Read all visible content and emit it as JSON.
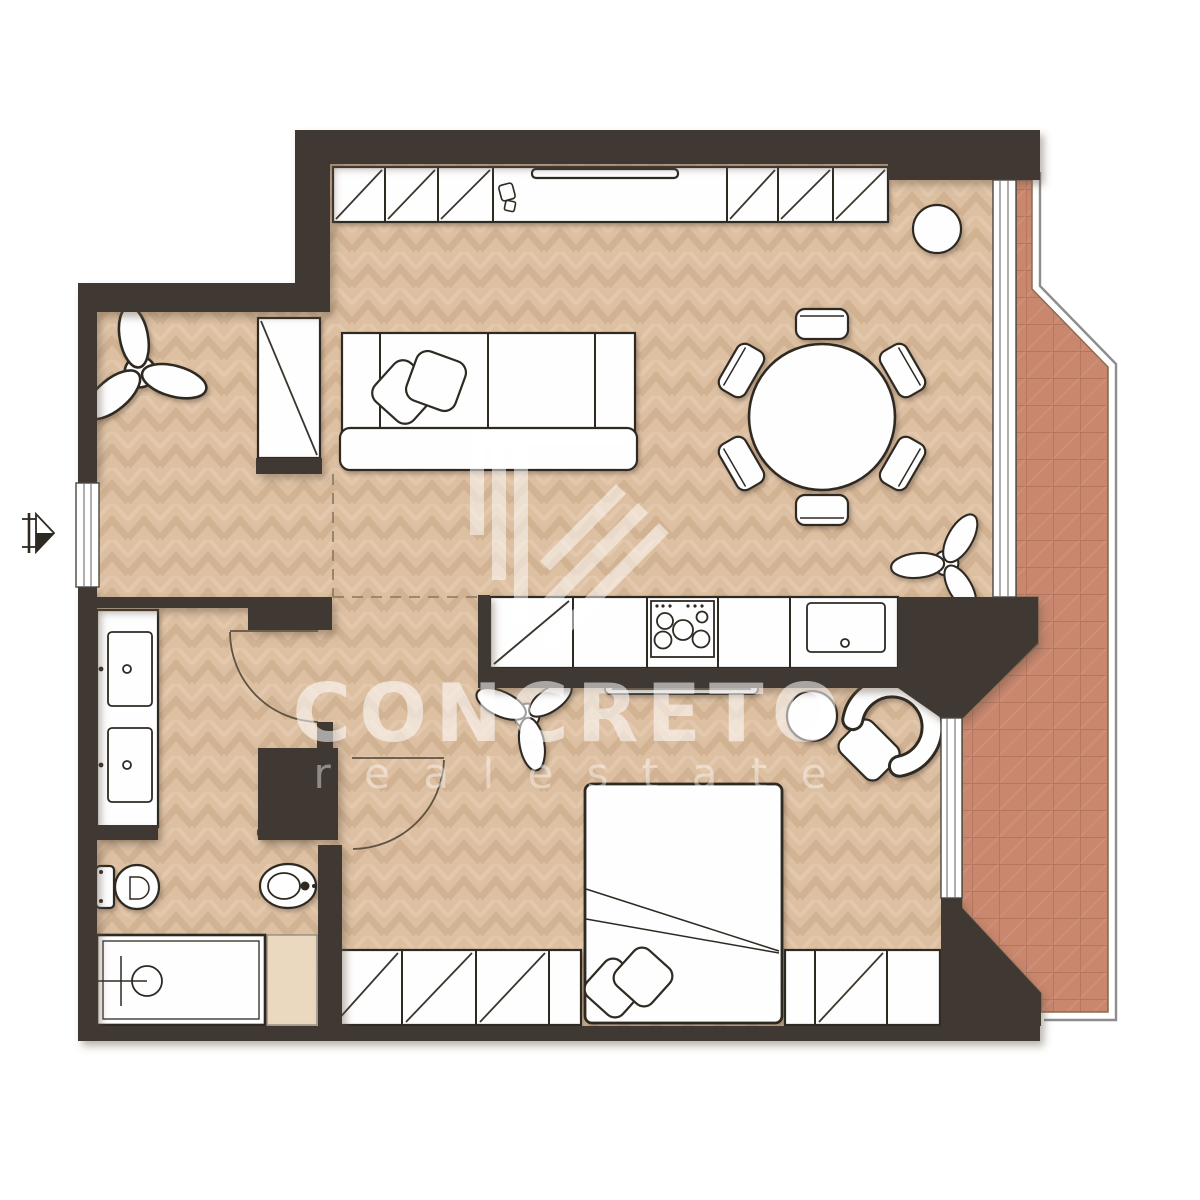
{
  "watermark": {
    "brand": "CONCRETO",
    "tagline": "r e a l e s t a t e"
  },
  "colors": {
    "wall": "#3f3831",
    "floor_wood": "#ddc0a2",
    "terrace_tile": "#c9876e",
    "bath_tile_accent": "#ead9bf",
    "furniture_fill": "#fefefe",
    "furniture_outline": "#2e2922",
    "background": "#ffffff",
    "watermark_white": "rgba(255,255,255,0.55)"
  }
}
